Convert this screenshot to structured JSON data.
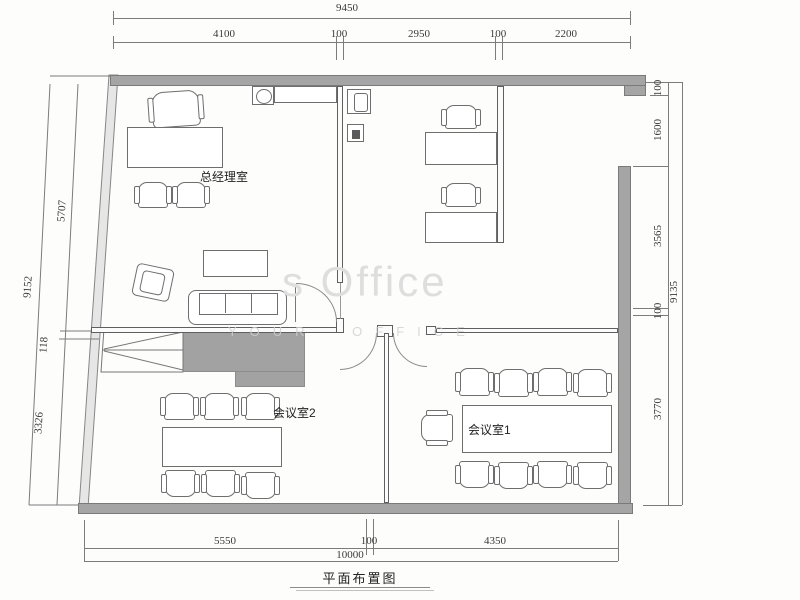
{
  "drawing": {
    "title": "平面布置图",
    "watermark_line1": "s Office",
    "watermark_line2": "YOUR OFFICE"
  },
  "rooms": {
    "manager_office": "总经理室",
    "meeting_room_2": "会议室2",
    "meeting_room_1": "会议室1"
  },
  "dimensions": {
    "top": {
      "total": "9450",
      "segments": [
        "4100",
        "100",
        "2950",
        "100",
        "2200"
      ]
    },
    "bottom": {
      "total": "10000",
      "segments": [
        "5550",
        "100",
        "4350"
      ]
    },
    "left": {
      "total": "9152",
      "segments": [
        "5707",
        "118",
        "3326"
      ]
    },
    "right": {
      "total": "9135",
      "segments": [
        "100",
        "1600",
        "3565",
        "100",
        "3770"
      ]
    }
  },
  "colors": {
    "wall": "#a5a5a5",
    "wall_edge": "#7a7a7a",
    "furniture_line": "#6e6e6e",
    "dimension_line": "#7c7c7c",
    "core_fill": "#a2a2a2",
    "watermark": "#dedede"
  }
}
